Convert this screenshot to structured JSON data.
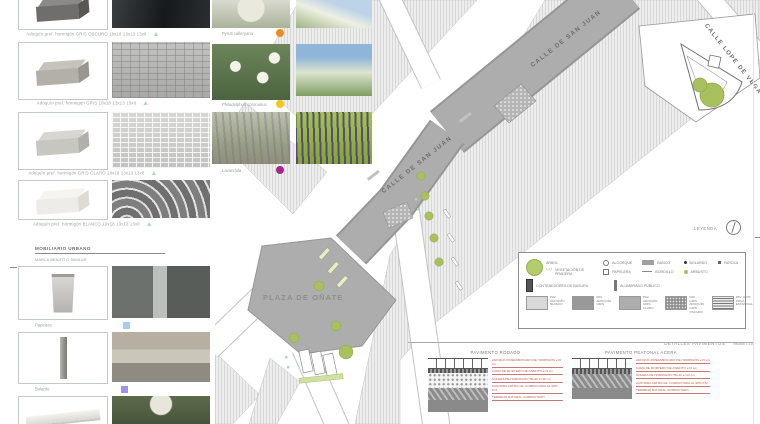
{
  "colors": {
    "tree_green": "#a9c05f",
    "legend_green": "#b5cc6e",
    "street_gray": "#adadad",
    "annotation_red": "#b85c55",
    "marker_mint": "#a9e0b0",
    "marker_orange": "#ef8c1e",
    "marker_yellow": "#f2c71c",
    "marker_magenta": "#a6278c",
    "marker_blue": "#a9cdf0",
    "marker_violet": "#9b97e6"
  },
  "materials": {
    "items": [
      {
        "label": "Adoquín pref. hormigón GRIS OSCURO 18x18 13x13 13x8"
      },
      {
        "label": "Adoquín pref. hormigón GRIS 18x18 13x13 13x8"
      },
      {
        "label": "Adoquín pref. hormigón GRIS CLARO 18x18 13x13 13x8"
      },
      {
        "label": "Adoquín pref. hormigón BLANCO 18x18 13x13 13x8"
      }
    ]
  },
  "vegetation": {
    "items": [
      {
        "label": "Pyrus calleryana"
      },
      {
        "label": "Philadelphus coronarius"
      },
      {
        "label": "Lavandula"
      }
    ]
  },
  "furniture": {
    "heading": "MOBILIARIO URBANO",
    "subheading": "MARCA BENITO O SIMILAR",
    "items": [
      {
        "label": "Papelera"
      },
      {
        "label": "Bolardo"
      }
    ]
  },
  "plan": {
    "street_san_juan_upper": "CALLE DE SAN JUAN",
    "street_san_juan_lower": "CALLE DE SAN JUAN",
    "street_lope": "CALLE LOPE DE VEGA",
    "plaza": "PLAZA DE OÑATE"
  },
  "legend": {
    "title": "LEYENDA",
    "items": {
      "arbol": "ÁRBOL",
      "pradera": "VEGETACIÓN DE PRADERA",
      "alcorque": "ALCORQUE",
      "papelera": "PAPELERA",
      "banco": "BANCO",
      "bordillo": "BORDILLO",
      "bolardo": "BOLARDO",
      "arbusto": "ARBUSTO",
      "farola": "FAROLA",
      "contenedores": "CONTENEDORES DE BASURA",
      "alumbrado": "ALUMBRADO PÚBLICO"
    },
    "pavements": [
      {
        "l1": "PAV.",
        "l2": "ADOQUÍN BLANCO"
      },
      {
        "l1": "PAV.",
        "l2": "ADOQUÍN GRIS"
      },
      {
        "l1": "PAV.",
        "l2": "ADOQUÍN GRIS CLARO"
      },
      {
        "l1": "PAV. GRIS",
        "l2": "ADOQUÍN GRIS OSCURO"
      },
      {
        "l1": "PAV. GRIS",
        "l2": "ZONA ESTANCIAL"
      }
    ]
  },
  "details": {
    "header": "DETALLES PAVIMENTOS",
    "scale": "escala 1:10",
    "left": {
      "title": "PAVIMENTO RODADO",
      "annotations": [
        "ADOQUÍN PREFABRICADO DE HORMIGÓN e=8 cm",
        "CAMA DE MORTERO DE ASIENTO e=3 cm",
        "SOLERA DE HORMIGÓN HM-20 e=15 cm",
        "ZAHORRA ARTIFICIAL COMPACTADA AL 98% P.M.",
        "TERRENO NATURAL COMPACTADO"
      ]
    },
    "right": {
      "title": "PAVIMENTO PEATONAL ACERA",
      "annotations": [
        "ADOQUÍN PREFABRICADO DE HORMIGÓN e=6 cm",
        "CAMA DE MORTERO DE ASIENTO e=3 cm",
        "SOLERA DE HORMIGÓN HM-20 e=10 cm",
        "ZAHORRA ARTIFICIAL COMPACTADA AL 98% P.M.",
        "TERRENO NATURAL COMPACTADO"
      ]
    }
  }
}
